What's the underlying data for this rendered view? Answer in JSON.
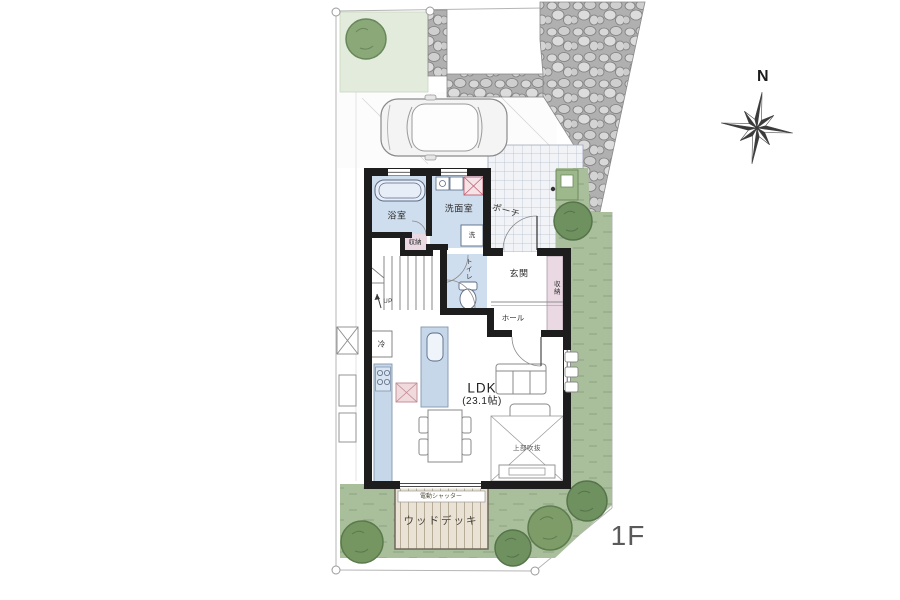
{
  "meta": {
    "floor_label": "1F",
    "compass_letter": "N"
  },
  "rooms": {
    "bath": {
      "label": "浴室"
    },
    "washroom": {
      "label": "洗面室"
    },
    "washer_box": {
      "label": "洗"
    },
    "stairs": {
      "label": "UP"
    },
    "storage_hall": {
      "label": "収納"
    },
    "toilet": {
      "label": "トイレ"
    },
    "entrance": {
      "label": "玄関"
    },
    "hall": {
      "label": "ホール"
    },
    "entrance_storage": {
      "label": "収納"
    },
    "fridge": {
      "label": "冷"
    },
    "ldk": {
      "label": "LDK",
      "size": "(23.1帖)"
    },
    "void": {
      "label": "上部吹抜"
    }
  },
  "exterior": {
    "porch": {
      "label": "ポーチ"
    },
    "deck": {
      "label": "ウッドデッキ",
      "shutter_label": "電動シャッター"
    }
  },
  "colors": {
    "wall": "#1d1d1d",
    "wet_floor": "#cfdeee",
    "kitchen_counter": "#c6d7ea",
    "storage_pink": "#ead9e2",
    "lawn": "#e3ecdc",
    "garden": "#a9bf9b",
    "tree": "#7d9b6e",
    "deck_wood": "#eae2d4",
    "stone": "#b0b0b0",
    "tile": "#f1f3f7"
  }
}
